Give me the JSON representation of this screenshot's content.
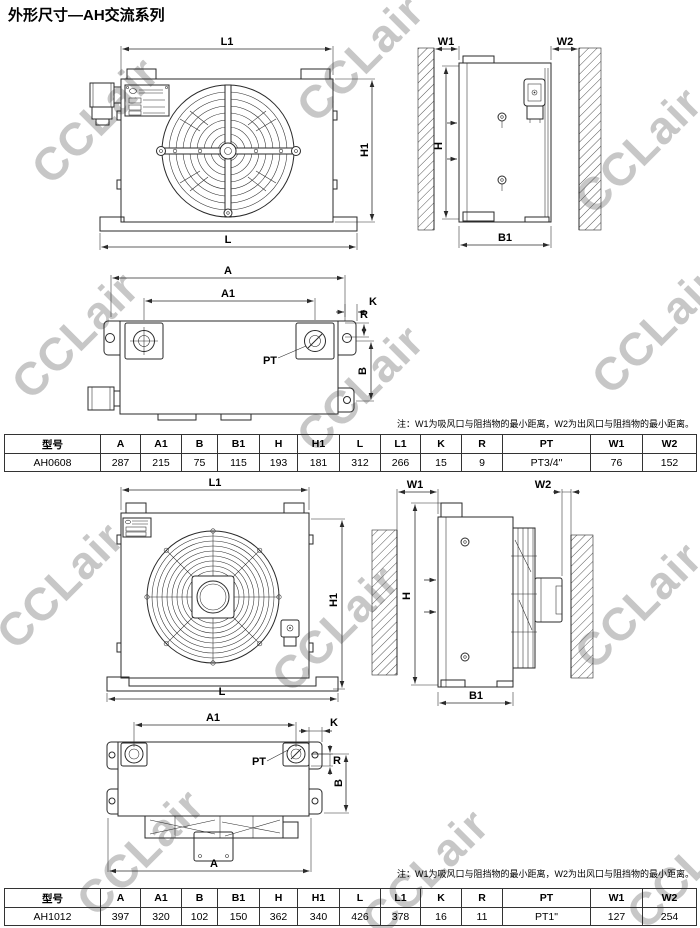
{
  "page": {
    "title": "外形尺寸—AH交流系列",
    "watermark_text": "CCLair"
  },
  "dim_labels": {
    "L1": "L1",
    "H1": "H1",
    "L": "L",
    "W1": "W1",
    "W2": "W2",
    "H": "H",
    "B1": "B1",
    "A": "A",
    "A1": "A1",
    "K": "K",
    "R": "R",
    "B": "B",
    "PT": "PT"
  },
  "notes": {
    "note1": "注：W1为吸风口与阻挡物的最小距离，W2为出风口与阻挡物的最小距离。",
    "note2": "注：W1为吸风口与阻挡物的最小距离，W2为出风口与阻挡物的最小距离。"
  },
  "tables": {
    "table1": {
      "headers": [
        "型号",
        "A",
        "A1",
        "B",
        "B1",
        "H",
        "H1",
        "L",
        "L1",
        "K",
        "R",
        "PT",
        "W1",
        "W2"
      ],
      "rows": [
        [
          "AH0608",
          "287",
          "215",
          "75",
          "115",
          "193",
          "181",
          "312",
          "266",
          "15",
          "9",
          "PT3/4\"",
          "76",
          "152"
        ]
      ]
    },
    "table2": {
      "headers": [
        "型号",
        "A",
        "A1",
        "B",
        "B1",
        "H",
        "H1",
        "L",
        "L1",
        "K",
        "R",
        "PT",
        "W1",
        "W2"
      ],
      "rows": [
        [
          "AH1012",
          "397",
          "320",
          "102",
          "150",
          "362",
          "340",
          "426",
          "378",
          "16",
          "11",
          "PT1\"",
          "127",
          "254"
        ]
      ]
    }
  }
}
